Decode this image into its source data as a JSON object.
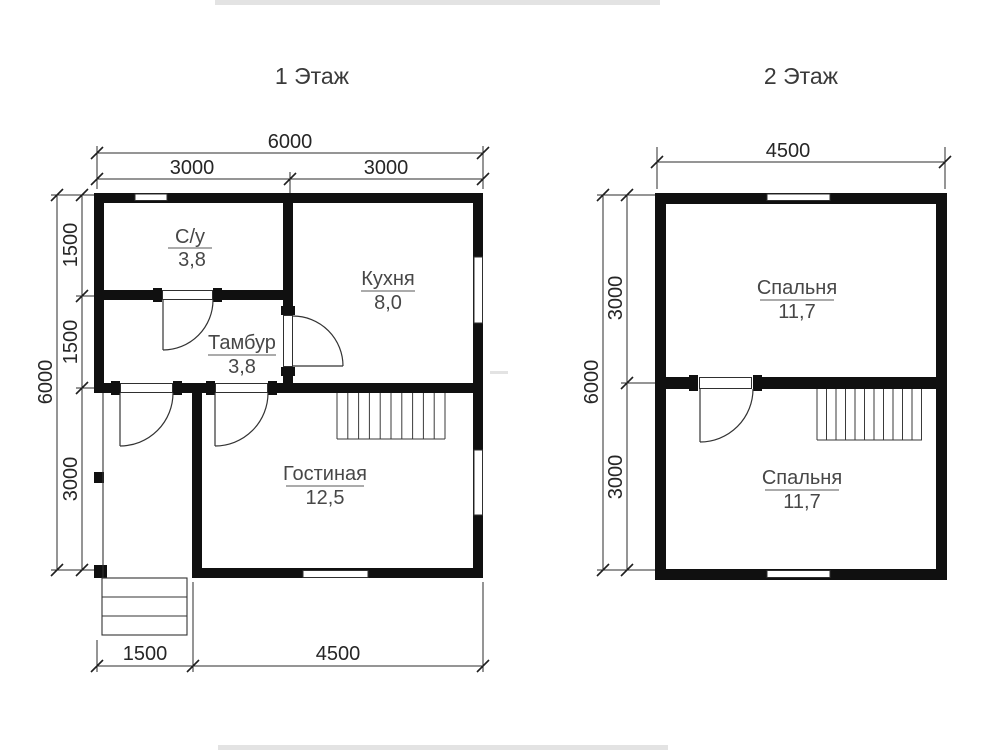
{
  "floor1": {
    "title": "1 Этаж",
    "dims": {
      "top_total": "6000",
      "top_seg_left": "3000",
      "top_seg_right": "3000",
      "left_total": "6000",
      "left_seg_1": "1500",
      "left_seg_2": "1500",
      "left_seg_3": "3000",
      "bottom_seg_left": "1500",
      "bottom_seg_right": "4500"
    },
    "rooms": {
      "bathroom": {
        "name": "С/у",
        "area": "3,8"
      },
      "kitchen": {
        "name": "Кухня",
        "area": "8,0"
      },
      "vestibule": {
        "name": "Тамбур",
        "area": "3,8"
      },
      "living": {
        "name": "Гостиная",
        "area": "12,5"
      }
    }
  },
  "floor2": {
    "title": "2 Этаж",
    "dims": {
      "top_total": "4500",
      "left_total": "6000",
      "left_seg_1": "3000",
      "left_seg_2": "3000"
    },
    "rooms": {
      "bedroom_top": {
        "name": "Спальня",
        "area": "11,7"
      },
      "bedroom_bottom": {
        "name": "Спальня",
        "area": "11,7"
      }
    }
  },
  "colors": {
    "walls": "#101010",
    "thin_lines": "#333333",
    "text": "#3a3a3a"
  }
}
